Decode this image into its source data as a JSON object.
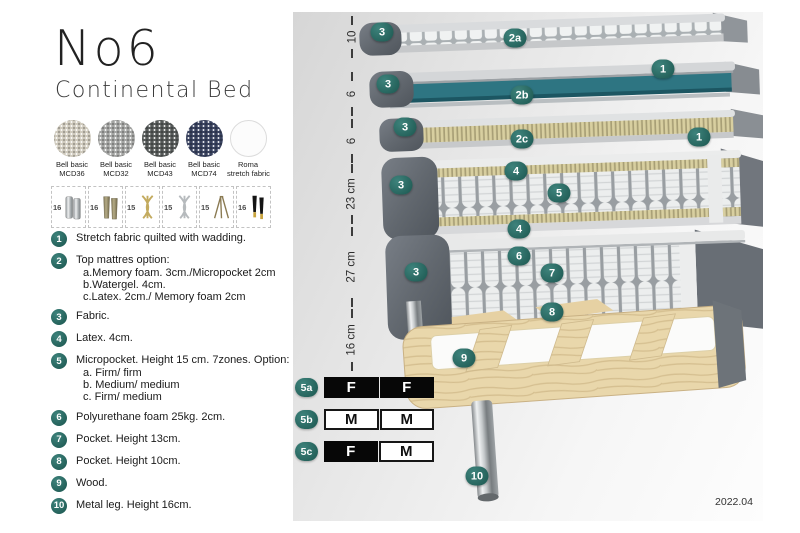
{
  "header": {
    "title": "No6",
    "subtitle": "Continental Bed"
  },
  "fabrics": [
    {
      "line1": "Bell basic",
      "line2": "MCD36"
    },
    {
      "line1": "Bell basic",
      "line2": "MCD32"
    },
    {
      "line1": "Bell basic",
      "line2": "MCD43"
    },
    {
      "line1": "Bell basic",
      "line2": "MCD74"
    },
    {
      "line1": "Roma",
      "line2": "stretch fabric"
    }
  ],
  "legs": [
    {
      "size": "16"
    },
    {
      "size": "16"
    },
    {
      "size": "15"
    },
    {
      "size": "15"
    },
    {
      "size": "15"
    },
    {
      "size": "16"
    }
  ],
  "list": {
    "items": [
      {
        "num": "1",
        "text": "Stretch fabric quilted with wadding."
      },
      {
        "num": "2",
        "text": "Top mattres option:",
        "options": [
          "a.Memory foam. 3cm./Micropocket 2cm",
          "b.Watergel. 4cm.",
          "c.Latex. 2cm./ Memory foam 2cm"
        ]
      },
      {
        "num": "3",
        "text": "Fabric."
      },
      {
        "num": "4",
        "text": "Latex. 4cm."
      },
      {
        "num": "5",
        "text": "Micropocket. Height 15 cm. 7zones. Option:",
        "options": [
          "a. Firm/ firm",
          "b. Medium/ medium",
          "c. Firm/ medium"
        ]
      },
      {
        "num": "6",
        "text": "Polyurethane foam 25kg. 2cm."
      },
      {
        "num": "7",
        "text": "Pocket. Height 13cm."
      },
      {
        "num": "8",
        "text": "Pocket. Height 10cm."
      },
      {
        "num": "9",
        "text": "Wood."
      },
      {
        "num": "10",
        "text": "Metal leg. Height 16cm."
      }
    ]
  },
  "diagram": {
    "dimensions": [
      {
        "label": "10"
      },
      {
        "label": "6"
      },
      {
        "label": "6"
      },
      {
        "label": "23 cm"
      },
      {
        "label": "27 cm"
      },
      {
        "label": "16 cm"
      }
    ],
    "badges": [
      {
        "label": "3"
      },
      {
        "label": "2a"
      },
      {
        "label": "1"
      },
      {
        "label": "3"
      },
      {
        "label": "2b"
      },
      {
        "label": "3"
      },
      {
        "label": "2c"
      },
      {
        "label": "1"
      },
      {
        "label": "3"
      },
      {
        "label": "4"
      },
      {
        "label": "5"
      },
      {
        "label": "4"
      },
      {
        "label": "6"
      },
      {
        "label": "7"
      },
      {
        "label": "3"
      },
      {
        "label": "8"
      },
      {
        "label": "9"
      },
      {
        "label": "10"
      }
    ],
    "firmness": [
      {
        "id": "5a",
        "cells": [
          {
            "text": "F",
            "variant": "dark"
          },
          {
            "text": "F",
            "variant": "dark"
          }
        ]
      },
      {
        "id": "5b",
        "cells": [
          {
            "text": "M",
            "variant": "light"
          },
          {
            "text": "M",
            "variant": "light"
          }
        ]
      },
      {
        "id": "5c",
        "cells": [
          {
            "text": "F",
            "variant": "dark"
          },
          {
            "text": "M",
            "variant": "light"
          }
        ]
      }
    ],
    "version": "2022.04"
  },
  "colors": {
    "badge_teal": "#2C6F6A",
    "watergel_teal": "#2E7582",
    "firm_cell_black": "#070707",
    "fabric_dark_gray": "#5E636A",
    "micropocket_cream": "#D8CFA0",
    "wood": "#E9D7AB"
  }
}
